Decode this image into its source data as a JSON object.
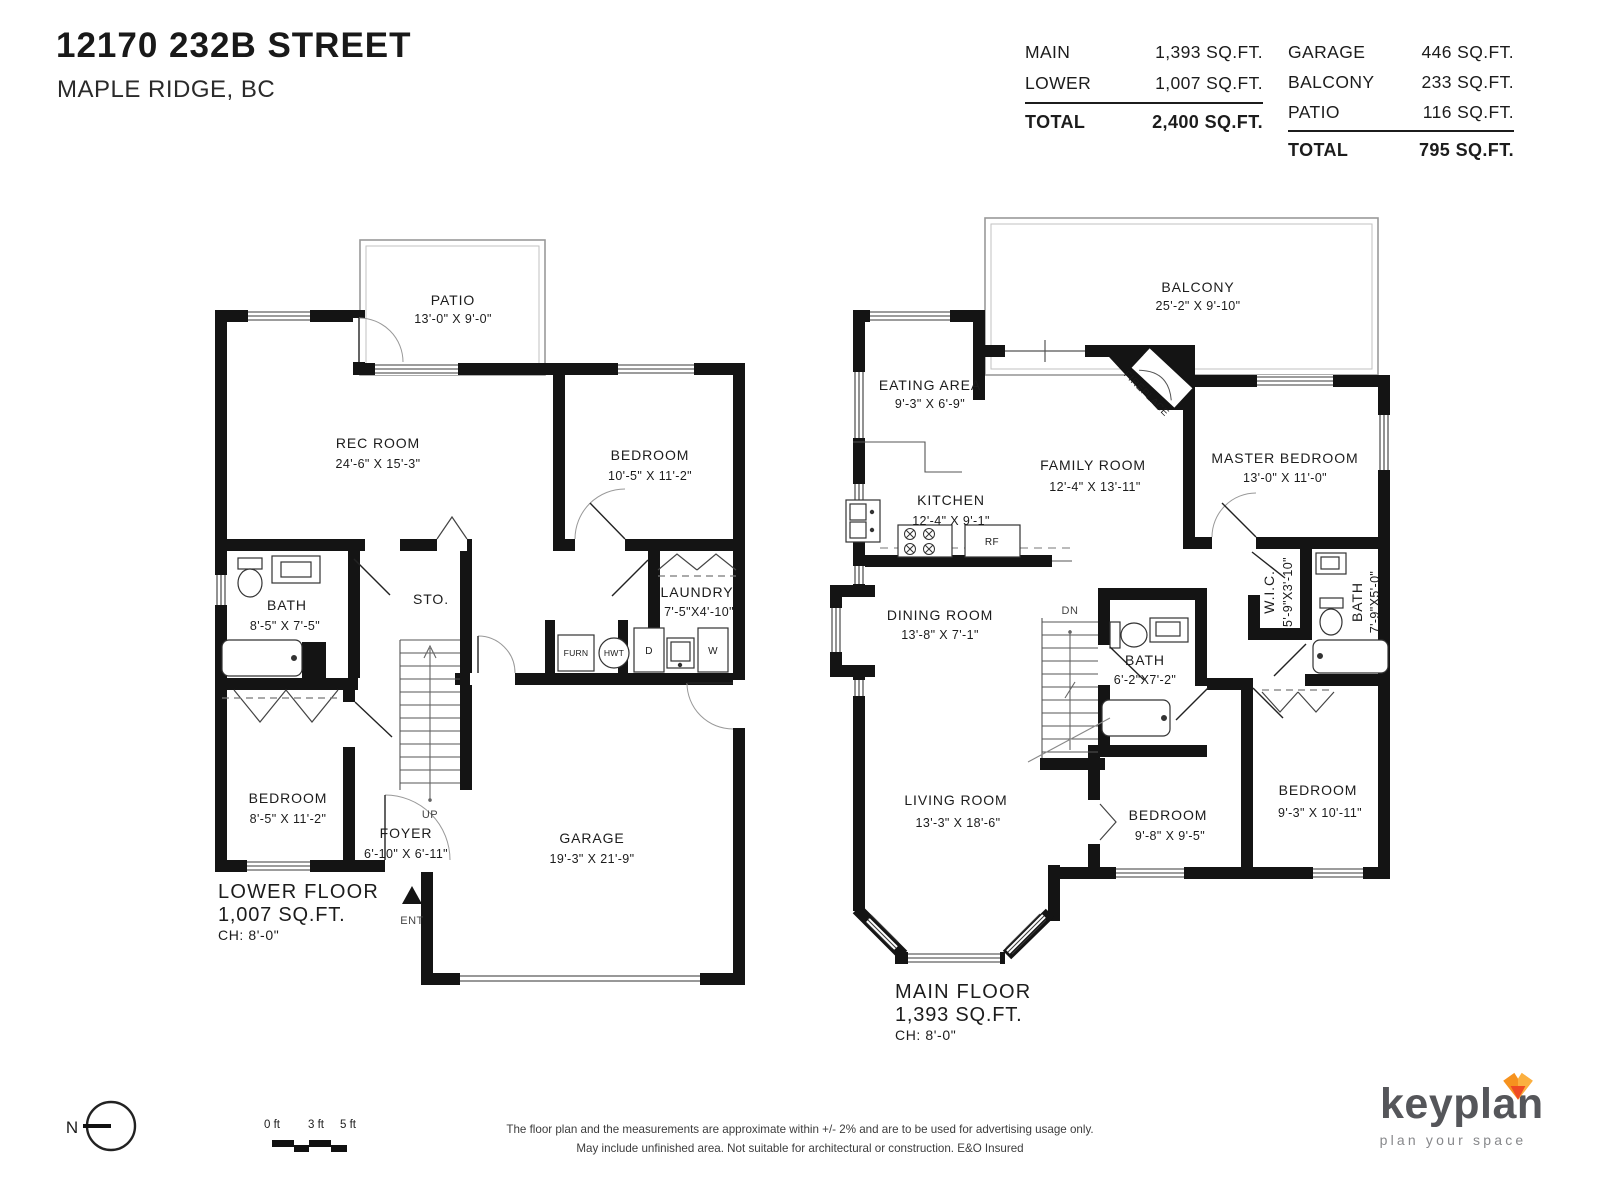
{
  "header": {
    "title": "12170 232B STREET",
    "subtitle": "MAPLE RIDGE, BC"
  },
  "area_table": {
    "building": {
      "rows": [
        {
          "label": "MAIN",
          "value": "1,393 SQ.FT."
        },
        {
          "label": "LOWER",
          "value": "1,007 SQ.FT."
        }
      ],
      "total_label": "TOTAL",
      "total_value": "2,400 SQ.FT."
    },
    "outdoor": {
      "rows": [
        {
          "label": "GARAGE",
          "value": "446 SQ.FT."
        },
        {
          "label": "BALCONY",
          "value": "233 SQ.FT."
        },
        {
          "label": "PATIO",
          "value": "116 SQ.FT."
        }
      ],
      "total_label": "TOTAL",
      "total_value": "795 SQ.FT."
    }
  },
  "lower_floor": {
    "title": "LOWER FLOOR",
    "area": "1,007 SQ.FT.",
    "ceiling": "CH: 8'-0\"",
    "rooms": {
      "patio": {
        "label": "PATIO",
        "dims": "13'-0\"  X  9'-0\""
      },
      "rec_room": {
        "label": "REC ROOM",
        "dims": "24'-6\"  X  15'-3\""
      },
      "bedroom1": {
        "label": "BEDROOM",
        "dims": "10'-5\"  X  11'-2\""
      },
      "bath": {
        "label": "BATH",
        "dims": "8'-5\"  X  7'-5\""
      },
      "laundry": {
        "label": "LAUNDRY",
        "dims": "7'-5\"X4'-10\""
      },
      "storage": {
        "label": "STO."
      },
      "bedroom2": {
        "label": "BEDROOM",
        "dims": "8'-5\"  X  11'-2\""
      },
      "foyer": {
        "label": "FOYER",
        "dims": "6'-10\"  X  6'-11\""
      },
      "garage": {
        "label": "GARAGE",
        "dims": "19'-3\"  X  21'-9\""
      }
    },
    "markers": {
      "up": "UP",
      "ent": "ENT",
      "furn": "FURN",
      "hwt": "HWT",
      "dryer": "D",
      "washer": "W"
    }
  },
  "main_floor": {
    "title": "MAIN FLOOR",
    "area": "1,393 SQ.FT.",
    "ceiling": "CH: 8'-0\"",
    "rooms": {
      "balcony": {
        "label": "BALCONY",
        "dims": "25'-2\"  X  9'-10\""
      },
      "eating_area": {
        "label": "EATING AREA",
        "dims": "9'-3\"  X  6'-9\""
      },
      "kitchen": {
        "label": "KITCHEN",
        "dims": "12'-4\"  X  9'-1\""
      },
      "family_room": {
        "label": "FAMILY ROOM",
        "dims": "12'-4\"  X  13'-11\""
      },
      "master_bedroom": {
        "label": "MASTER BEDROOM",
        "dims": "13'-0\"  X  11'-0\""
      },
      "fireplace": {
        "label": "FIREPLACE"
      },
      "dining_room": {
        "label": "DINING ROOM",
        "dims": "13'-8\"  X  7'-1\""
      },
      "bath": {
        "label": "BATH",
        "dims": "6'-2\"X7'-2\""
      },
      "wic": {
        "label": "W.I.C.",
        "dims": "5'-9\"X3'-10\""
      },
      "bath2": {
        "label": "BATH",
        "dims": "7'-9\"X5'-0\""
      },
      "living_room": {
        "label": "LIVING ROOM",
        "dims": "13'-3\"  X  18'-6\""
      },
      "bedroom2": {
        "label": "BEDROOM",
        "dims": "9'-8\"  X  9'-5\""
      },
      "bedroom3": {
        "label": "BEDROOM",
        "dims": "9'-3\"  X  10'-11\""
      }
    },
    "markers": {
      "dn": "DN",
      "rf": "RF"
    }
  },
  "footer": {
    "north_label": "N",
    "scale_ticks": [
      "0 ft",
      "3 ft",
      "5 ft"
    ],
    "disclaimer_line1": "The floor plan and the measurements are approximate within +/- 2% and are to be used for advertising usage only.",
    "disclaimer_line2": "May include unfinished area. Not suitable for architectural or construction. E&O Insured",
    "brand": {
      "name": "keyplan",
      "tagline": "plan your space"
    }
  },
  "colors": {
    "wall": "#141414",
    "thin_line": "#999999",
    "text": "#1c1c1c",
    "fox_orange": "#f6921e",
    "fox_light": "#fbb040",
    "fox_red": "#ef4b23"
  }
}
